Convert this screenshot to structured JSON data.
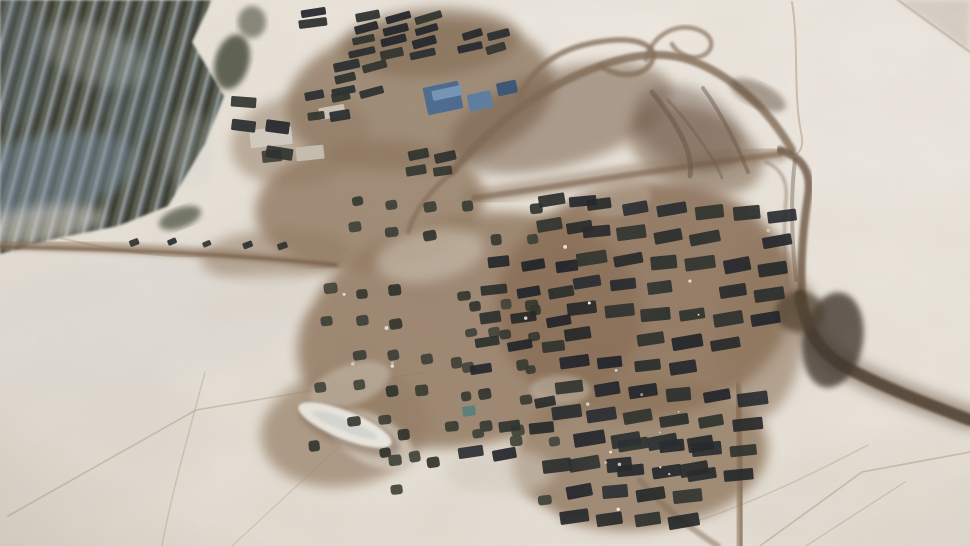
{
  "scene": {
    "type": "satellite-photo",
    "description": "Winter satellite image of a large military vehicle park and tent encampment on snow-covered ground, with dark forest at top-left, muddy trafficked compound in the center, gridded rows of dark vehicles, scattered tents, and brown access roads looping to the top-right and curving off the bottom-right",
    "seed": 7,
    "size": [
      970,
      546
    ],
    "colors": {
      "snow": "#eae4da",
      "snow_bright": "#f1ece4",
      "forest_dark": "#2b2f26",
      "forest_blue": "#7b93ab",
      "mud": "#8a7158",
      "mud_dark": "#5f4a38",
      "road_dark": "#3f3023",
      "vehicle_dark": "#14181a",
      "tent_dark": "#262a21",
      "roof_blue": "#42648c"
    },
    "snow_shades": [
      {
        "cx": 130,
        "cy": 320,
        "rx": 180,
        "ry": 70,
        "rot": -10,
        "c": "#c9d2da",
        "o": 0.18,
        "f": "f10"
      },
      {
        "cx": 80,
        "cy": 440,
        "rx": 140,
        "ry": 70,
        "rot": 0,
        "c": "#ded8ce",
        "o": 0.4,
        "f": "f10"
      },
      {
        "cx": 880,
        "cy": 490,
        "rx": 150,
        "ry": 55,
        "rot": -8,
        "c": "#ddd5c9",
        "o": 0.35,
        "f": "f10"
      },
      {
        "cx": 520,
        "cy": 60,
        "rx": 200,
        "ry": 60,
        "rot": 0,
        "c": "#f2ede6",
        "o": 0.5,
        "f": "f10"
      },
      {
        "cx": 880,
        "cy": 120,
        "rx": 120,
        "ry": 90,
        "rot": 0,
        "c": "#f1ece5",
        "o": 0.5,
        "f": "f10"
      }
    ],
    "corner_streak": {
      "points": "898,0 970,0 970,52",
      "c": "#cfc6ba",
      "o": 0.7
    },
    "tracks": [
      {
        "d": "M8,516 L196,410 L425,372",
        "w": 1.6,
        "c": "#a58a6f",
        "o": 0.4
      },
      {
        "d": "M205,372 C190,430 172,490 162,546",
        "w": 1.4,
        "c": "#a58a6f",
        "o": 0.35
      },
      {
        "d": "M232,546 L355,432",
        "w": 1.3,
        "c": "#a58a6f",
        "o": 0.3
      },
      {
        "d": "M760,546 L862,472 L970,452",
        "w": 1.6,
        "c": "#9c8166",
        "o": 0.4
      },
      {
        "d": "M806,546 L905,482",
        "w": 1.3,
        "c": "#9c8166",
        "o": 0.32
      },
      {
        "d": "M700,520 C760,500 820,470 868,445",
        "w": 1.4,
        "c": "#9c8166",
        "o": 0.3
      },
      {
        "d": "M792,2 C799,44 793,92 801,132 C805,150 797,158 790,152",
        "w": 2,
        "c": "#b4987c",
        "o": 0.55
      },
      {
        "d": "M898,0 L970,52",
        "w": 2.5,
        "c": "#b3a491",
        "o": 0.5
      },
      {
        "d": "M60,238 C120,252 170,258 205,256",
        "w": 2,
        "c": "#a58a6f",
        "o": 0.4
      }
    ],
    "forest": {
      "outline": "0,0 212,0 192,42 224,96 206,142 168,206 118,226 58,238 0,254",
      "clumps": [
        {
          "cx": 232,
          "cy": 62,
          "rx": 17,
          "ry": 28,
          "rot": 15,
          "c": "#3a402f",
          "o": 0.85,
          "f": "f3"
        },
        {
          "cx": 252,
          "cy": 22,
          "rx": 14,
          "ry": 16,
          "rot": 0,
          "c": "#3a402f",
          "o": 0.6,
          "f": "f3"
        },
        {
          "cx": 180,
          "cy": 218,
          "rx": 22,
          "ry": 10,
          "rot": -20,
          "c": "#39402f",
          "o": 0.7,
          "f": "f3"
        }
      ],
      "shadows": [
        {
          "cx": 45,
          "cy": 175,
          "rx": 95,
          "ry": 40,
          "rot": -12,
          "c": "#7b93ab",
          "o": 0.45,
          "f": "f6"
        },
        {
          "cx": 135,
          "cy": 90,
          "rx": 35,
          "ry": 55,
          "rot": 8,
          "c": "#6e88a2",
          "o": 0.22,
          "f": "f6"
        },
        {
          "cx": 10,
          "cy": 60,
          "rx": 40,
          "ry": 70,
          "rot": 0,
          "c": "#748ca6",
          "o": 0.2,
          "f": "f6"
        }
      ],
      "lights": [
        {
          "cx": 95,
          "cy": 55,
          "rx": 55,
          "ry": 28,
          "rot": 20,
          "c": "#ccd2d2",
          "o": 0.25,
          "f": "f6"
        },
        {
          "cx": 35,
          "cy": 225,
          "rx": 70,
          "ry": 18,
          "rot": -8,
          "c": "#dcd8d0",
          "o": 0.55,
          "f": "f6"
        },
        {
          "cx": 190,
          "cy": 150,
          "rx": 25,
          "ry": 40,
          "rot": 0,
          "c": "#c9cfcf",
          "o": 0.2,
          "f": "f6"
        }
      ]
    },
    "mud": [
      {
        "cx": 420,
        "cy": 95,
        "rx": 135,
        "ry": 75,
        "rot": -8,
        "c": "#8e7860",
        "o": 0.85,
        "f": "f6"
      },
      {
        "cx": 370,
        "cy": 205,
        "rx": 115,
        "ry": 65,
        "rot": -5,
        "c": "#8a7158",
        "o": 0.8,
        "f": "f6"
      },
      {
        "cx": 470,
        "cy": 330,
        "rx": 175,
        "ry": 115,
        "rot": -12,
        "c": "#8d735a",
        "o": 0.85,
        "f": "f6"
      },
      {
        "cx": 645,
        "cy": 300,
        "rx": 150,
        "ry": 118,
        "rot": -8,
        "c": "#85684f",
        "o": 0.88,
        "f": "f6"
      },
      {
        "cx": 640,
        "cy": 455,
        "rx": 128,
        "ry": 75,
        "rot": -5,
        "c": "#8a6f55",
        "o": 0.8,
        "f": "f6"
      },
      {
        "cx": 345,
        "cy": 428,
        "rx": 85,
        "ry": 58,
        "rot": -10,
        "c": "#91785f",
        "o": 0.7,
        "f": "f6"
      },
      {
        "cx": 275,
        "cy": 255,
        "rx": 75,
        "ry": 26,
        "rot": -4,
        "c": "#8d745b",
        "o": 0.55,
        "f": "f6"
      },
      {
        "cx": 300,
        "cy": 140,
        "rx": 70,
        "ry": 45,
        "rot": -10,
        "c": "#8a7158",
        "o": 0.5,
        "f": "f6"
      },
      {
        "cx": 560,
        "cy": 118,
        "rx": 115,
        "ry": 48,
        "rot": -16,
        "c": "#6f573f",
        "o": 0.55,
        "f": "f6"
      },
      {
        "cx": 430,
        "cy": 42,
        "rx": 90,
        "ry": 34,
        "rot": -4,
        "c": "#7c634a",
        "o": 0.6,
        "f": "f6"
      },
      {
        "cx": 695,
        "cy": 150,
        "rx": 70,
        "ry": 40,
        "rot": 20,
        "c": "#7a604a",
        "o": 0.6,
        "f": "f6"
      },
      {
        "cx": 760,
        "cy": 330,
        "rx": 45,
        "ry": 90,
        "rot": 5,
        "c": "#8a7057",
        "o": 0.6,
        "f": "f6"
      }
    ],
    "mud_lights": [
      {
        "cx": 430,
        "cy": 255,
        "rx": 55,
        "ry": 26,
        "rot": -10,
        "c": "#cfc4b5",
        "o": 0.6,
        "f": "f6"
      },
      {
        "cx": 372,
        "cy": 440,
        "rx": 46,
        "ry": 24,
        "rot": 28,
        "c": "#d8cfc2",
        "o": 0.7,
        "f": "f3"
      },
      {
        "cx": 560,
        "cy": 390,
        "rx": 30,
        "ry": 15,
        "rot": 0,
        "c": "#c9bfb0",
        "o": 0.5,
        "f": "f3"
      },
      {
        "cx": 618,
        "cy": 200,
        "rx": 34,
        "ry": 16,
        "rot": -10,
        "c": "#bfb2a0",
        "o": 0.4,
        "f": "f3"
      },
      {
        "cx": 500,
        "cy": 472,
        "rx": 55,
        "ry": 24,
        "rot": 0,
        "c": "#d5ccbf",
        "o": 0.55,
        "f": "f6"
      },
      {
        "cx": 350,
        "cy": 385,
        "rx": 42,
        "ry": 20,
        "rot": -20,
        "c": "#d2c8ba",
        "o": 0.5,
        "f": "f3"
      },
      {
        "cx": 470,
        "cy": 525,
        "rx": 90,
        "ry": 30,
        "rot": 0,
        "c": "#e7e1d7",
        "o": 0.85,
        "f": "f6"
      },
      {
        "cx": 255,
        "cy": 300,
        "rx": 60,
        "ry": 25,
        "rot": -8,
        "c": "#e2dbd1",
        "o": 0.6,
        "f": "f6"
      }
    ],
    "roads": [
      {
        "d": "M0,244 C110,247 235,252 338,266",
        "w": 9,
        "c": "#8b7259",
        "o": 0.7,
        "f": "f3"
      },
      {
        "d": "M0,247 C110,249 235,254 336,265",
        "w": 3.5,
        "c": "#6e553f",
        "o": 0.75,
        "f": "f1"
      },
      {
        "d": "M452,172 C498,118 548,82 612,62 C662,47 696,56 734,84 C760,103 778,126 792,150",
        "w": 8,
        "c": "#77604a",
        "o": 0.8,
        "f": "f1"
      },
      {
        "d": "M518,100 C532,66 560,48 598,42 C640,35 660,47 651,63 C641,79 615,77 601,66",
        "w": 5.5,
        "c": "#7c654f",
        "o": 0.75,
        "f": "f1"
      },
      {
        "d": "M646,60 C650,38 674,22 696,29 C718,36 714,54 698,57 C688,59 676,52 672,44",
        "w": 4.5,
        "c": "#836b54",
        "o": 0.7,
        "f": "f1"
      },
      {
        "d": "M470,198 C575,182 672,165 780,153",
        "w": 18,
        "c": "#8a7158",
        "o": 0.45,
        "f": "f3"
      },
      {
        "d": "M474,198 C575,184 672,167 780,154",
        "w": 6,
        "c": "#715741",
        "o": 0.6,
        "f": "f1"
      },
      {
        "d": "M780,150 C802,157 812,172 808,196 C803,228 800,262 802,298",
        "w": 8,
        "c": "#6b5340",
        "o": 0.85,
        "f": "f1"
      },
      {
        "d": "M766,162 C780,168 788,180 786,200 C784,222 784,250 787,285",
        "w": 3,
        "c": "#7d6550",
        "o": 0.5,
        "f": "f1"
      },
      {
        "d": "M800,296 C806,330 820,352 842,365 C880,386 925,403 970,418",
        "w": 24,
        "c": "#5a4533",
        "o": 0.5,
        "f": "f6"
      },
      {
        "d": "M800,296 C806,330 820,352 842,365 C880,386 925,403 970,420",
        "w": 12,
        "c": "#3f3023",
        "o": 0.85,
        "f": "f1"
      },
      {
        "d": "M737,385 C739,435 742,495 741,546",
        "w": 13,
        "c": "#8d7459",
        "o": 0.65,
        "f": "f3"
      },
      {
        "d": "M737,385 C739,435 743,495 742,546",
        "w": 5,
        "c": "#715741",
        "o": 0.5,
        "f": "f1"
      },
      {
        "d": "M640,480 C660,505 690,528 718,546",
        "w": 6,
        "c": "#7d6550",
        "o": 0.5,
        "f": "f1"
      },
      {
        "d": "M455,170 C430,190 415,210 408,232",
        "w": 5,
        "c": "#7a6149",
        "o": 0.6,
        "f": "f1"
      }
    ],
    "dark_blobs": {
      "ellipses": [
        {
          "cx": 688,
          "cy": 128,
          "rx": 58,
          "ry": 38,
          "rot": 28,
          "c": "#5f4a3a",
          "o": 0.45,
          "f": "f6"
        },
        {
          "cx": 833,
          "cy": 340,
          "rx": 30,
          "ry": 48,
          "rot": 10,
          "c": "#352a20",
          "o": 0.8,
          "f": "f3"
        },
        {
          "cx": 800,
          "cy": 312,
          "rx": 25,
          "ry": 20,
          "rot": 0,
          "c": "#463828",
          "o": 0.7,
          "f": "f3"
        },
        {
          "cx": 758,
          "cy": 95,
          "rx": 30,
          "ry": 12,
          "rot": 25,
          "c": "#5c4736",
          "o": 0.5,
          "f": "f3"
        }
      ],
      "strokes": [
        {
          "d": "M652,92 C676,122 694,152 690,176",
          "w": 5,
          "c": "#5c4736",
          "o": 0.5
        },
        {
          "d": "M703,88 C726,120 740,152 748,172",
          "w": 4,
          "c": "#5c4736",
          "o": 0.45
        },
        {
          "d": "M668,100 C695,130 715,160 722,178",
          "w": 3,
          "c": "#64503e",
          "o": 0.4
        },
        {
          "d": "M795,160 C790,200 792,240 796,280",
          "w": 4,
          "c": "#5a4634",
          "o": 0.4
        }
      ]
    },
    "mound": {
      "cx": 345,
      "cy": 425,
      "rx": 50,
      "ry": 14,
      "rot": 22
    },
    "buildings": [
      {
        "x": 443,
        "y": 98,
        "w": 36,
        "h": 28,
        "rot": -12,
        "c": "#42648c"
      },
      {
        "x": 447,
        "y": 93,
        "w": 30,
        "h": 10,
        "rot": -12,
        "c": "#6f92b5"
      },
      {
        "x": 480,
        "y": 101,
        "w": 24,
        "h": 17,
        "rot": -12,
        "c": "#54789f"
      },
      {
        "x": 507,
        "y": 88,
        "w": 20,
        "h": 13,
        "rot": -12,
        "c": "#2e4e70"
      },
      {
        "x": 469,
        "y": 411,
        "w": 13,
        "h": 10,
        "rot": -8,
        "c": "#4f7a74"
      },
      {
        "x": 271,
        "y": 137,
        "w": 42,
        "h": 18,
        "rot": -6,
        "c": "#d3ccc1"
      },
      {
        "x": 310,
        "y": 153,
        "w": 28,
        "h": 14,
        "rot": -6,
        "c": "#c7beb1"
      },
      {
        "x": 272,
        "y": 156,
        "w": 20,
        "h": 12,
        "rot": -6,
        "c": "#3a3b33"
      },
      {
        "x": 332,
        "y": 112,
        "w": 26,
        "h": 12,
        "rot": -10,
        "c": "#ccc3b6"
      }
    ],
    "vehicle_palette": [
      "#14181a",
      "#1a1f1e",
      "#10151c",
      "#1e2420",
      "#171c22"
    ],
    "tent_palette": [
      "#262a21",
      "#2e3128",
      "#1f241d",
      "#33362c"
    ],
    "vehicle_clusters": [
      {
        "x": 600,
        "y": 205,
        "cols": 6,
        "rows": 11,
        "dx": 36.5,
        "dy": 26,
        "shx": -4.3,
        "shy": 2.2,
        "w": 27,
        "h": 12,
        "rot": -8,
        "skip": 0.12,
        "jit": 2.5
      },
      {
        "x": 552,
        "y": 200,
        "cols": 2,
        "rows": 2,
        "dx": 30,
        "dy": 25,
        "shx": -3,
        "shy": 2,
        "w": 24,
        "h": 11,
        "rot": -8,
        "skip": 0.1,
        "jit": 2
      },
      {
        "x": 498,
        "y": 262,
        "cols": 3,
        "rows": 8,
        "dx": 34,
        "dy": 27,
        "shx": -4,
        "shy": 2,
        "w": 23,
        "h": 10,
        "rot": -8,
        "skip": 0.3,
        "jit": 3
      },
      {
        "x": 588,
        "y": 438,
        "cols": 4,
        "rows": 4,
        "dx": 37,
        "dy": 26,
        "shx": -5,
        "shy": 2,
        "w": 28,
        "h": 13,
        "rot": -8,
        "skip": 0.15,
        "jit": 3
      },
      {
        "x": 368,
        "y": 16,
        "cols": 3,
        "rows": 4,
        "dx": 30,
        "dy": 12,
        "shx": -2,
        "shy": 1,
        "w": 25,
        "h": 8,
        "rot": -14,
        "skip": 0.08,
        "jit": 1.5
      },
      {
        "x": 472,
        "y": 34,
        "cols": 2,
        "rows": 2,
        "dx": 26,
        "dy": 13,
        "shx": -2,
        "shy": 1,
        "w": 22,
        "h": 8,
        "rot": -14,
        "skip": 0,
        "jit": 1.5
      },
      {
        "x": 347,
        "y": 65,
        "cols": 2,
        "rows": 3,
        "dx": 28,
        "dy": 13,
        "shx": -2,
        "shy": 1,
        "w": 23,
        "h": 8,
        "rot": -14,
        "skip": 0.05,
        "jit": 1.5
      },
      {
        "x": 313,
        "y": 12,
        "cols": 1,
        "rows": 2,
        "dx": 0,
        "dy": 11,
        "shx": 0,
        "shy": 0,
        "w": 25,
        "h": 8,
        "rot": -6,
        "skip": 0,
        "jit": 1
      },
      {
        "x": 243,
        "y": 102,
        "cols": 2,
        "rows": 3,
        "dx": 33,
        "dy": 24,
        "shx": 2,
        "shy": 2,
        "w": 25,
        "h": 11,
        "rot": 6,
        "skip": 0.1,
        "jit": 3
      },
      {
        "x": 418,
        "y": 155,
        "cols": 2,
        "rows": 2,
        "dx": 27,
        "dy": 15,
        "shx": -2,
        "shy": 1,
        "w": 21,
        "h": 9,
        "rot": -10,
        "skip": 0,
        "jit": 2
      },
      {
        "x": 315,
        "y": 95,
        "cols": 2,
        "rows": 2,
        "dx": 24,
        "dy": 20,
        "shx": 0,
        "shy": 0,
        "w": 18,
        "h": 9,
        "rot": -10,
        "skip": 0,
        "jit": 4
      },
      {
        "x": 132,
        "y": 240,
        "cols": 5,
        "rows": 1,
        "dx": 38,
        "dy": 0,
        "shx": 0,
        "shy": 1,
        "w": 9,
        "h": 6,
        "rot": -20,
        "skip": 0.2,
        "jit": 6
      }
    ],
    "tent_clusters": [
      {
        "x": 332,
        "y": 288,
        "cols": 7,
        "rows": 6,
        "dx": 33,
        "dy": 32,
        "shx": -3,
        "shy": 2.5,
        "w": 12,
        "h": 10,
        "rot": -8,
        "skip": 0.3,
        "jit": 7,
        "rx": 3
      },
      {
        "x": 358,
        "y": 200,
        "cols": 6,
        "rows": 2,
        "dx": 36,
        "dy": 29,
        "shx": -3,
        "shy": 2,
        "w": 12,
        "h": 10,
        "rot": -8,
        "skip": 0.28,
        "jit": 6,
        "rx": 3
      },
      {
        "x": 402,
        "y": 432,
        "cols": 5,
        "rows": 3,
        "dx": 38,
        "dy": 30,
        "shx": -4,
        "shy": 2,
        "w": 12,
        "h": 10,
        "rot": -8,
        "skip": 0.3,
        "jit": 6,
        "rx": 3
      },
      {
        "x": 474,
        "y": 305,
        "cols": 3,
        "rows": 4,
        "dx": 32,
        "dy": 30,
        "shx": -3,
        "shy": 2,
        "w": 11,
        "h": 9,
        "rot": -8,
        "skip": 0.35,
        "jit": 7,
        "rx": 3
      }
    ],
    "glints": {
      "areas": [
        {
          "x": 560,
          "y": 200,
          "w": 210,
          "h": 270,
          "n": 12
        },
        {
          "x": 330,
          "y": 280,
          "w": 200,
          "h": 170,
          "n": 6
        },
        {
          "x": 600,
          "y": 430,
          "w": 120,
          "h": 80,
          "n": 4
        }
      ]
    },
    "grain": {
      "fine_opacity": 0.2,
      "coarse_opacity": 0.12
    }
  }
}
